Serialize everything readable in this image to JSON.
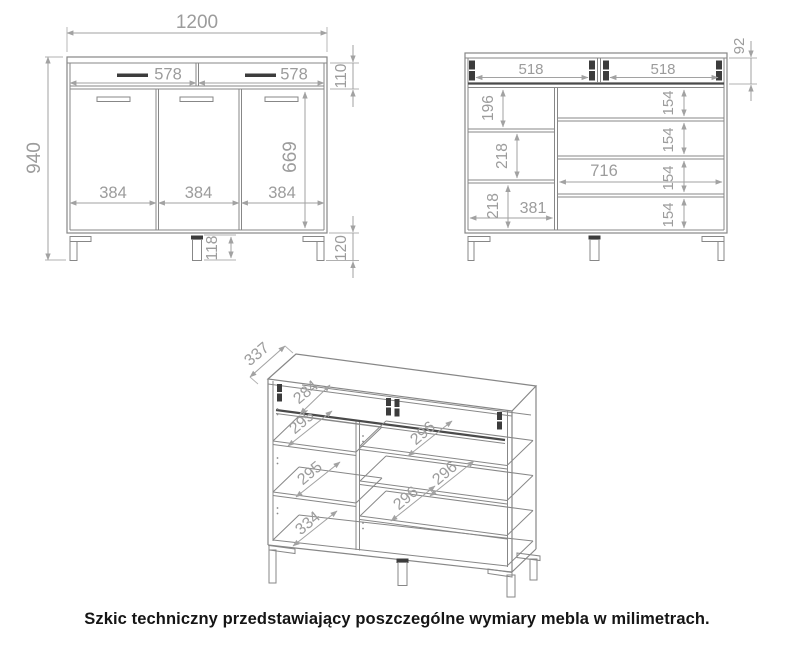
{
  "caption": "Szkic techniczny przedstawiający poszczególne wymiary mebla w milimetrach.",
  "units": "mm",
  "colors": {
    "background": "#ffffff",
    "object_line": "#878787",
    "dark_detail": "#3c3c3c",
    "dimension_line": "#a2a2a2",
    "dimension_text": "#9c9c9c",
    "caption_text": "#151515"
  },
  "front": {
    "overall_width": "1200",
    "overall_height": "940",
    "drawer_widths": [
      "578",
      "578"
    ],
    "drawer_front_height": "110",
    "door_widths": [
      "384",
      "384",
      "384"
    ],
    "door_height": "669",
    "center_leg_height": "118",
    "leg_height": "120"
  },
  "interior": {
    "drawer_widths": [
      "518",
      "518"
    ],
    "drawer_inner_height": "92",
    "left_compartments": [
      "196",
      "218",
      "218"
    ],
    "left_width": "381",
    "right_width": "716",
    "right_compartments": [
      "154",
      "154",
      "154",
      "154"
    ]
  },
  "iso": {
    "depth": "337",
    "drawer_depth": "284",
    "left_depths": [
      "295",
      "295"
    ],
    "left_bottom_depth": "334",
    "right_depths": [
      "296",
      "296",
      "296"
    ]
  }
}
